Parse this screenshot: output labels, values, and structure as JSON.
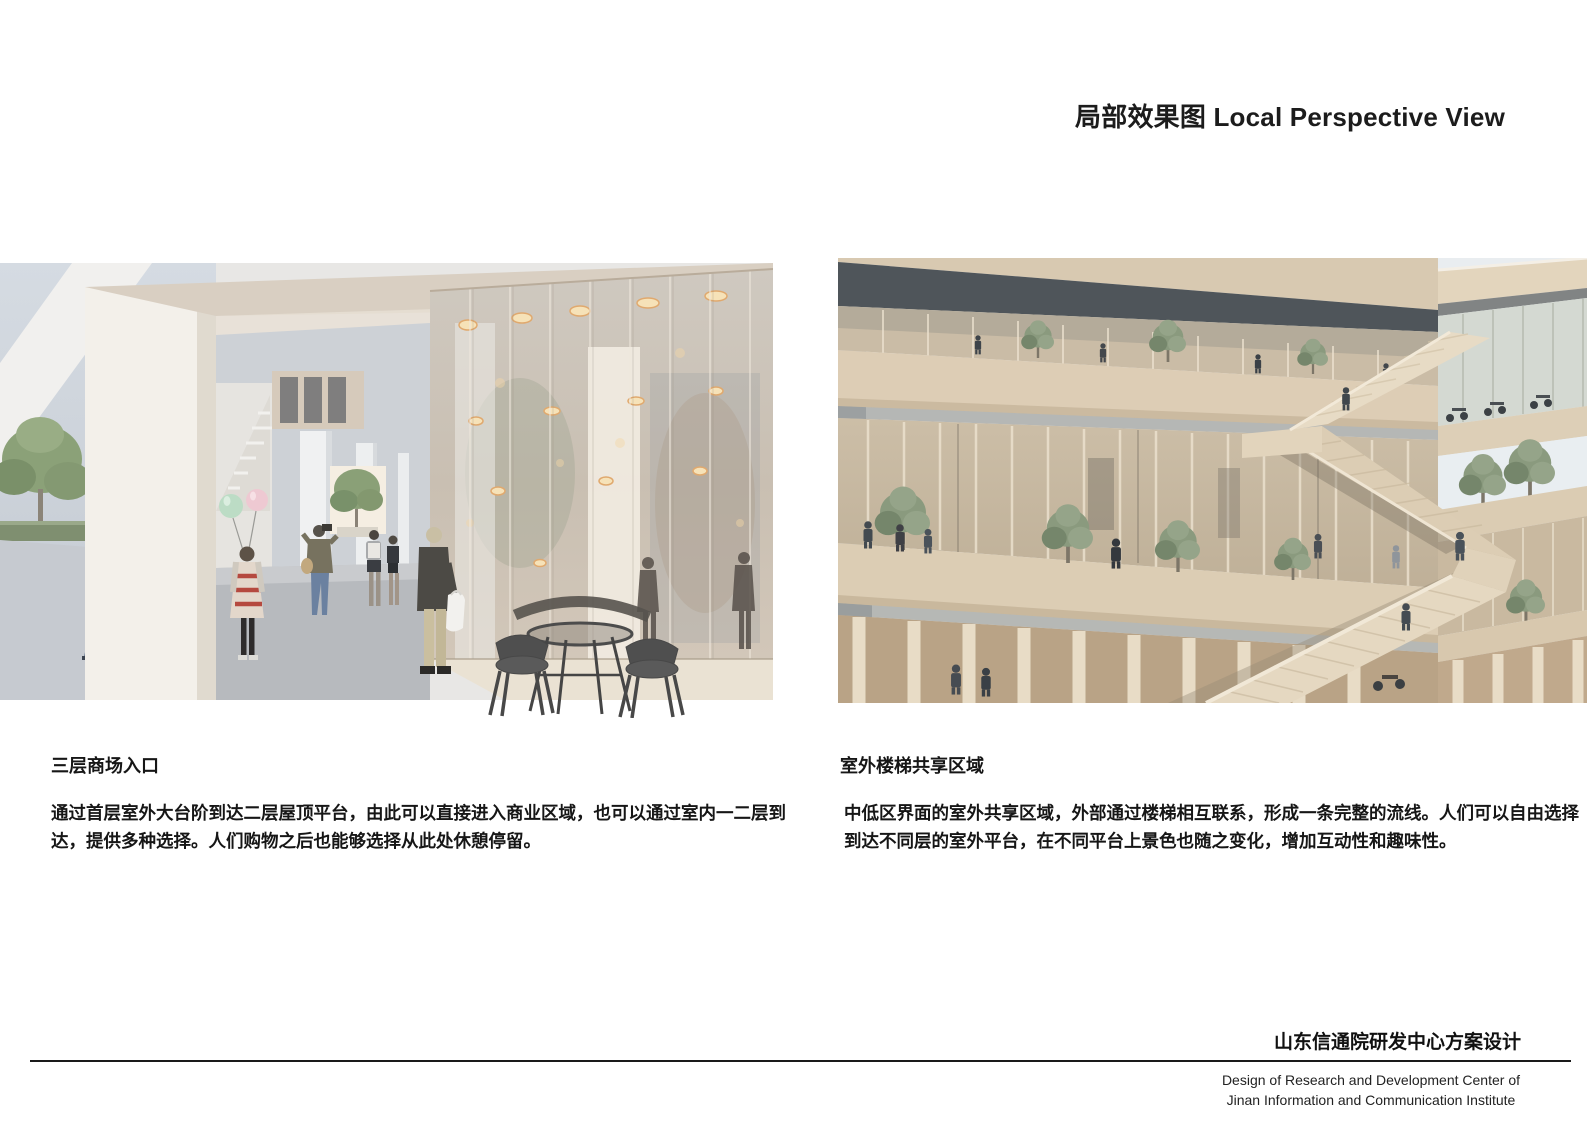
{
  "page": {
    "title": "局部效果图 Local Perspective View"
  },
  "panels": {
    "left": {
      "caption": "三层商场入口",
      "description_lines": [
        "通过首层室外大台阶到达二层屋顶平台，由此可以直接进入商业区域，也可以通过室内一二层到",
        "达，提供多种选择。人们购物之后也能够选择从此处休憩停留。"
      ]
    },
    "right": {
      "caption": "室外楼梯共享区域",
      "description_lines": [
        "中低区界面的室外共享区域，外部通过楼梯相互联系，形成一条完整的流线。人们可以自由选择",
        "到达不同层的室外平台，在不同平台上景色也随之变化，增加互动性和趣味性。"
      ]
    }
  },
  "footer": {
    "project_title_zh": "山东信通院研发中心方案设计",
    "project_title_en_lines": [
      "Design of Research and Development Center of",
      "Jinan Information and Communication Institute"
    ]
  },
  "palette": {
    "text": "#1a1a1a",
    "rule_line": "#1a1a1a",
    "render_cream_slab": "#dccdb5",
    "render_warm_glass": "#cfc0ad",
    "render_dark_ceiling": "#4f555a",
    "render_sky": "#e9edf0"
  }
}
